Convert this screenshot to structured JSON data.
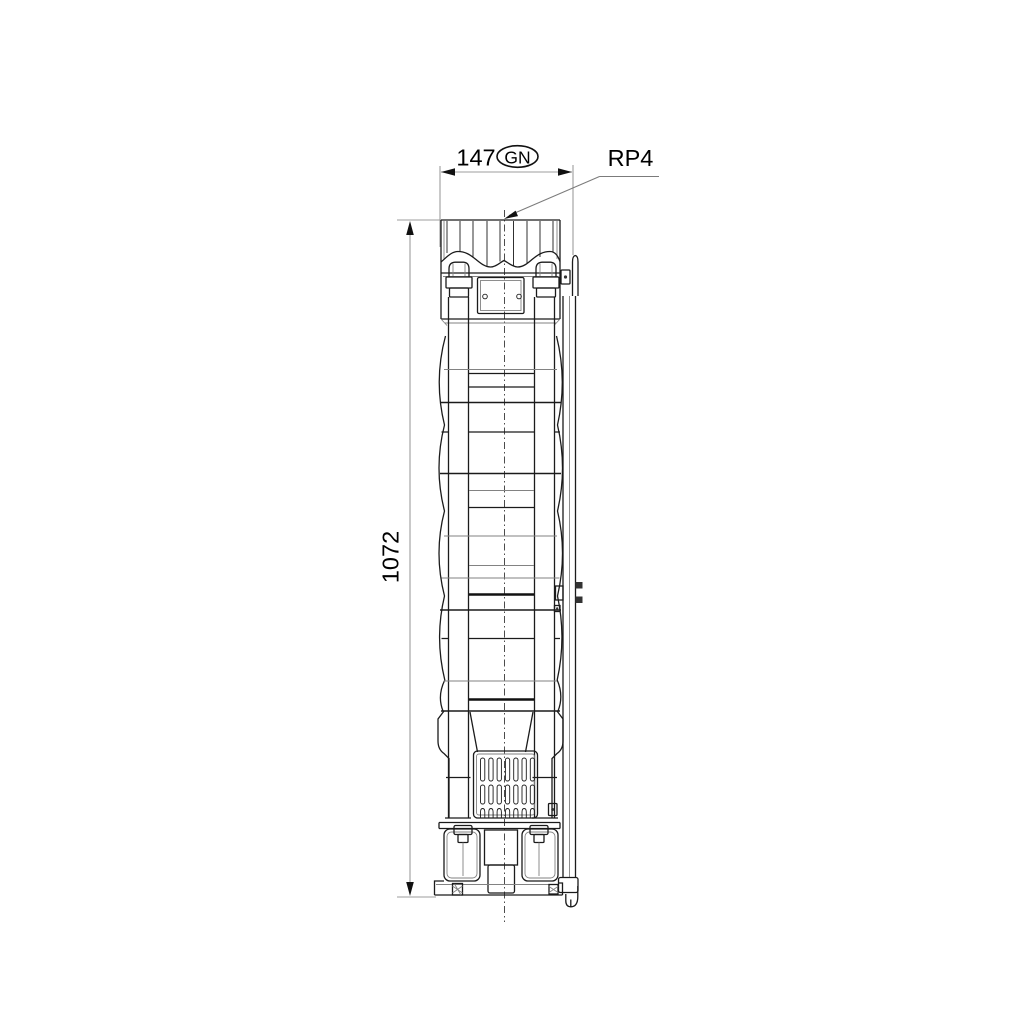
{
  "dimensions": {
    "width": {
      "value": "147",
      "tag": "GN"
    },
    "height": {
      "value": "1072"
    },
    "connection_label": "RP4"
  },
  "colors": {
    "background": "#ffffff",
    "part_line": "#1b1b1b",
    "secondary_line": "#828282",
    "dimension_line": "#9d9d9d",
    "leader_line": "#7b7b7b",
    "text": "#000000"
  }
}
